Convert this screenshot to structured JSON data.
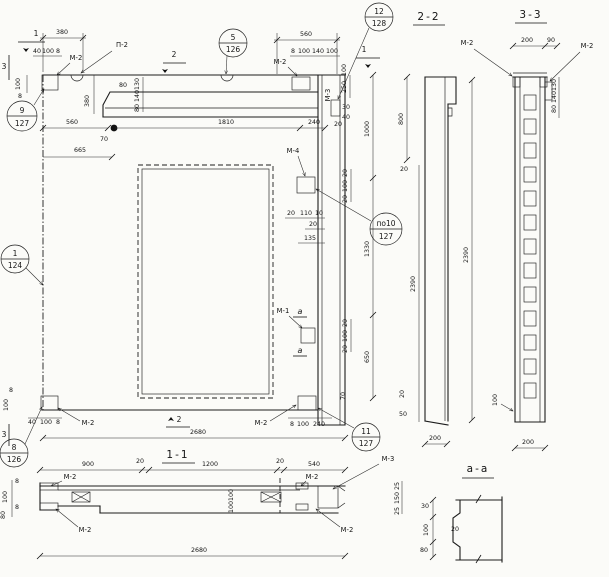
{
  "sections": {
    "s22": "2-2",
    "s33": "3-3",
    "s11": "1-1",
    "saa": "а-а"
  },
  "cuts": {
    "c1": "1",
    "c2": "2",
    "c3": "3",
    "ca": "а"
  },
  "markers": {
    "m1": "М-1",
    "m2": "М-2",
    "m3": "М-3",
    "m4": "М-4",
    "p2": "П-2"
  },
  "bubbles": {
    "b9": {
      "top": "9",
      "bot": "127"
    },
    "b5": {
      "top": "5",
      "bot": "126"
    },
    "b12": {
      "top": "12",
      "bot": "128"
    },
    "b1": {
      "top": "1",
      "bot": "124"
    },
    "b10": {
      "top": "по10",
      "bot": "127"
    },
    "b8": {
      "top": "8",
      "bot": "126"
    },
    "b11": {
      "top": "11",
      "bot": "127"
    }
  },
  "dims": {
    "d8": "8",
    "d10": "10",
    "d20": "20",
    "d25": "25",
    "d30": "30",
    "d40": "40",
    "d50": "50",
    "d70": "70",
    "d80": "80",
    "d90": "90",
    "d100": "100",
    "d110": "110",
    "d130": "130",
    "d135": "135",
    "d140": "140",
    "d150": "150",
    "d200": "200",
    "d240": "240",
    "d250": "250",
    "d380": "380",
    "d540": "540",
    "d560": "560",
    "d650": "650",
    "d665": "665",
    "d800": "800",
    "d900": "900",
    "d1000": "1000",
    "d1200": "1200",
    "d1330": "1330",
    "d1810": "1810",
    "d2390": "2390",
    "d2680": "2680"
  }
}
